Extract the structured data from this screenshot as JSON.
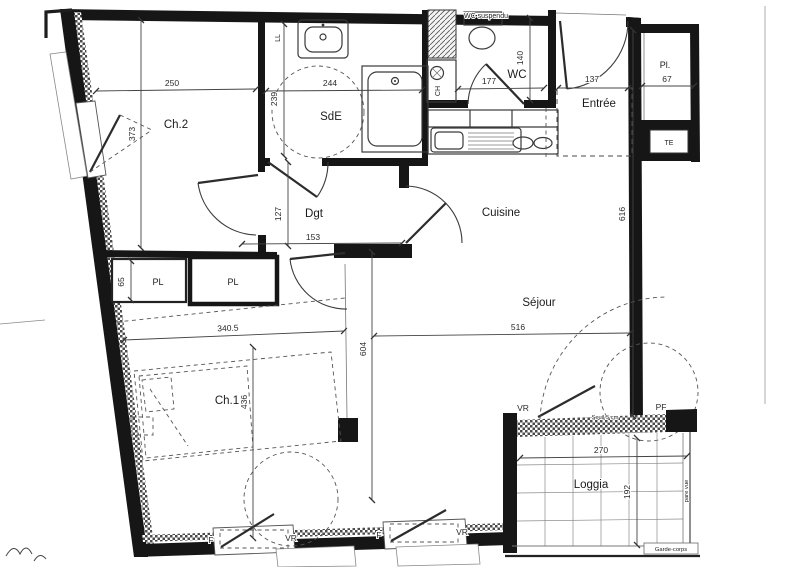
{
  "colors": {
    "wall": "#161616",
    "line": "#3a3a3a",
    "dash": "#555555",
    "paper": "#ffffff"
  },
  "rooms": {
    "ch2": "Ch.2",
    "sde": "SdE",
    "wc": "WC",
    "entree": "Entrée",
    "cuisine": "Cuisine",
    "sejour": "Séjour",
    "dgt": "Dgt",
    "ch1": "Ch.1",
    "loggia": "Loggia",
    "pl_entry": "Pl.",
    "pl_left": "PL",
    "pl_right": "PL",
    "te": "TE"
  },
  "dimensions": {
    "ch2_width": "250",
    "ch2_height": "373",
    "sde_height": "239",
    "sde_width": "244",
    "wc_width": "177",
    "wc_height": "140",
    "entree_width": "137",
    "pl_entry_width": "67",
    "east_wall_height": "616",
    "dgt_height": "127",
    "dgt_width": "153",
    "pl_depth": "65",
    "ch1_width": "340.5",
    "center_height": "604",
    "ch1_height": "436",
    "sejour_width": "516",
    "loggia_width": "270",
    "loggia_depth": "192"
  },
  "annotations": {
    "wc_type": "WC suspendu",
    "boiler": "CH",
    "washer": "LL",
    "window1_f": "F",
    "window1_vr": "VR",
    "window2_f": "F",
    "window2_vr": "VR",
    "pf_vr": "VR",
    "pf_label": "PF",
    "seuil": "Seuil 5 cm",
    "garde_corps": "Garde-corps",
    "pare_vue": "pare vue"
  }
}
